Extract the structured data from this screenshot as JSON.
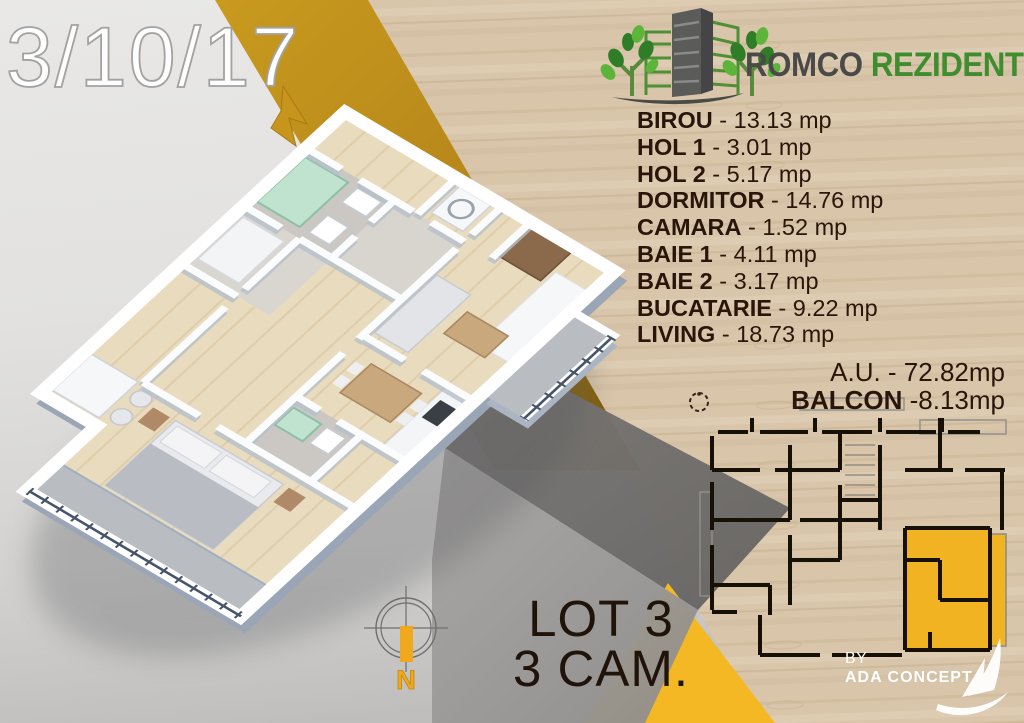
{
  "title": {
    "unit_code": "3/10/17"
  },
  "brand": {
    "primary": "ROMCO",
    "secondary": "REZIDENTIAL"
  },
  "rooms": [
    {
      "name": "BIROU",
      "area": "- 13.13 mp"
    },
    {
      "name": "HOL 1",
      "area": "- 3.01 mp"
    },
    {
      "name": "HOL 2",
      "area": "- 5.17 mp"
    },
    {
      "name": "DORMITOR",
      "area": "- 14.76 mp"
    },
    {
      "name": "CAMARA",
      "area": "- 1.52 mp"
    },
    {
      "name": "BAIE 1",
      "area": "- 4.11 mp"
    },
    {
      "name": "BAIE 2",
      "area": "- 3.17 mp"
    },
    {
      "name": "BUCATARIE",
      "area": "- 9.22 mp"
    },
    {
      "name": "LIVING",
      "area": "- 18.73 mp"
    }
  ],
  "summary": {
    "au_line": "A.U. - 72.82mp",
    "balcon_label": "BALCON",
    "balcon_value": " -8.13mp"
  },
  "lot": {
    "line1": "LOT 3",
    "line2": "3 CAM."
  },
  "credit": {
    "by": "BY",
    "studio": "ADA CONCEPT"
  },
  "compass": {
    "north_label": "N"
  },
  "colors": {
    "accent_yellow": "#F2B322",
    "gold_band": "#C2901C",
    "brand_green": "#3E8E2F",
    "text_dark": "#2A150A",
    "wood": "#D8C5AA"
  }
}
